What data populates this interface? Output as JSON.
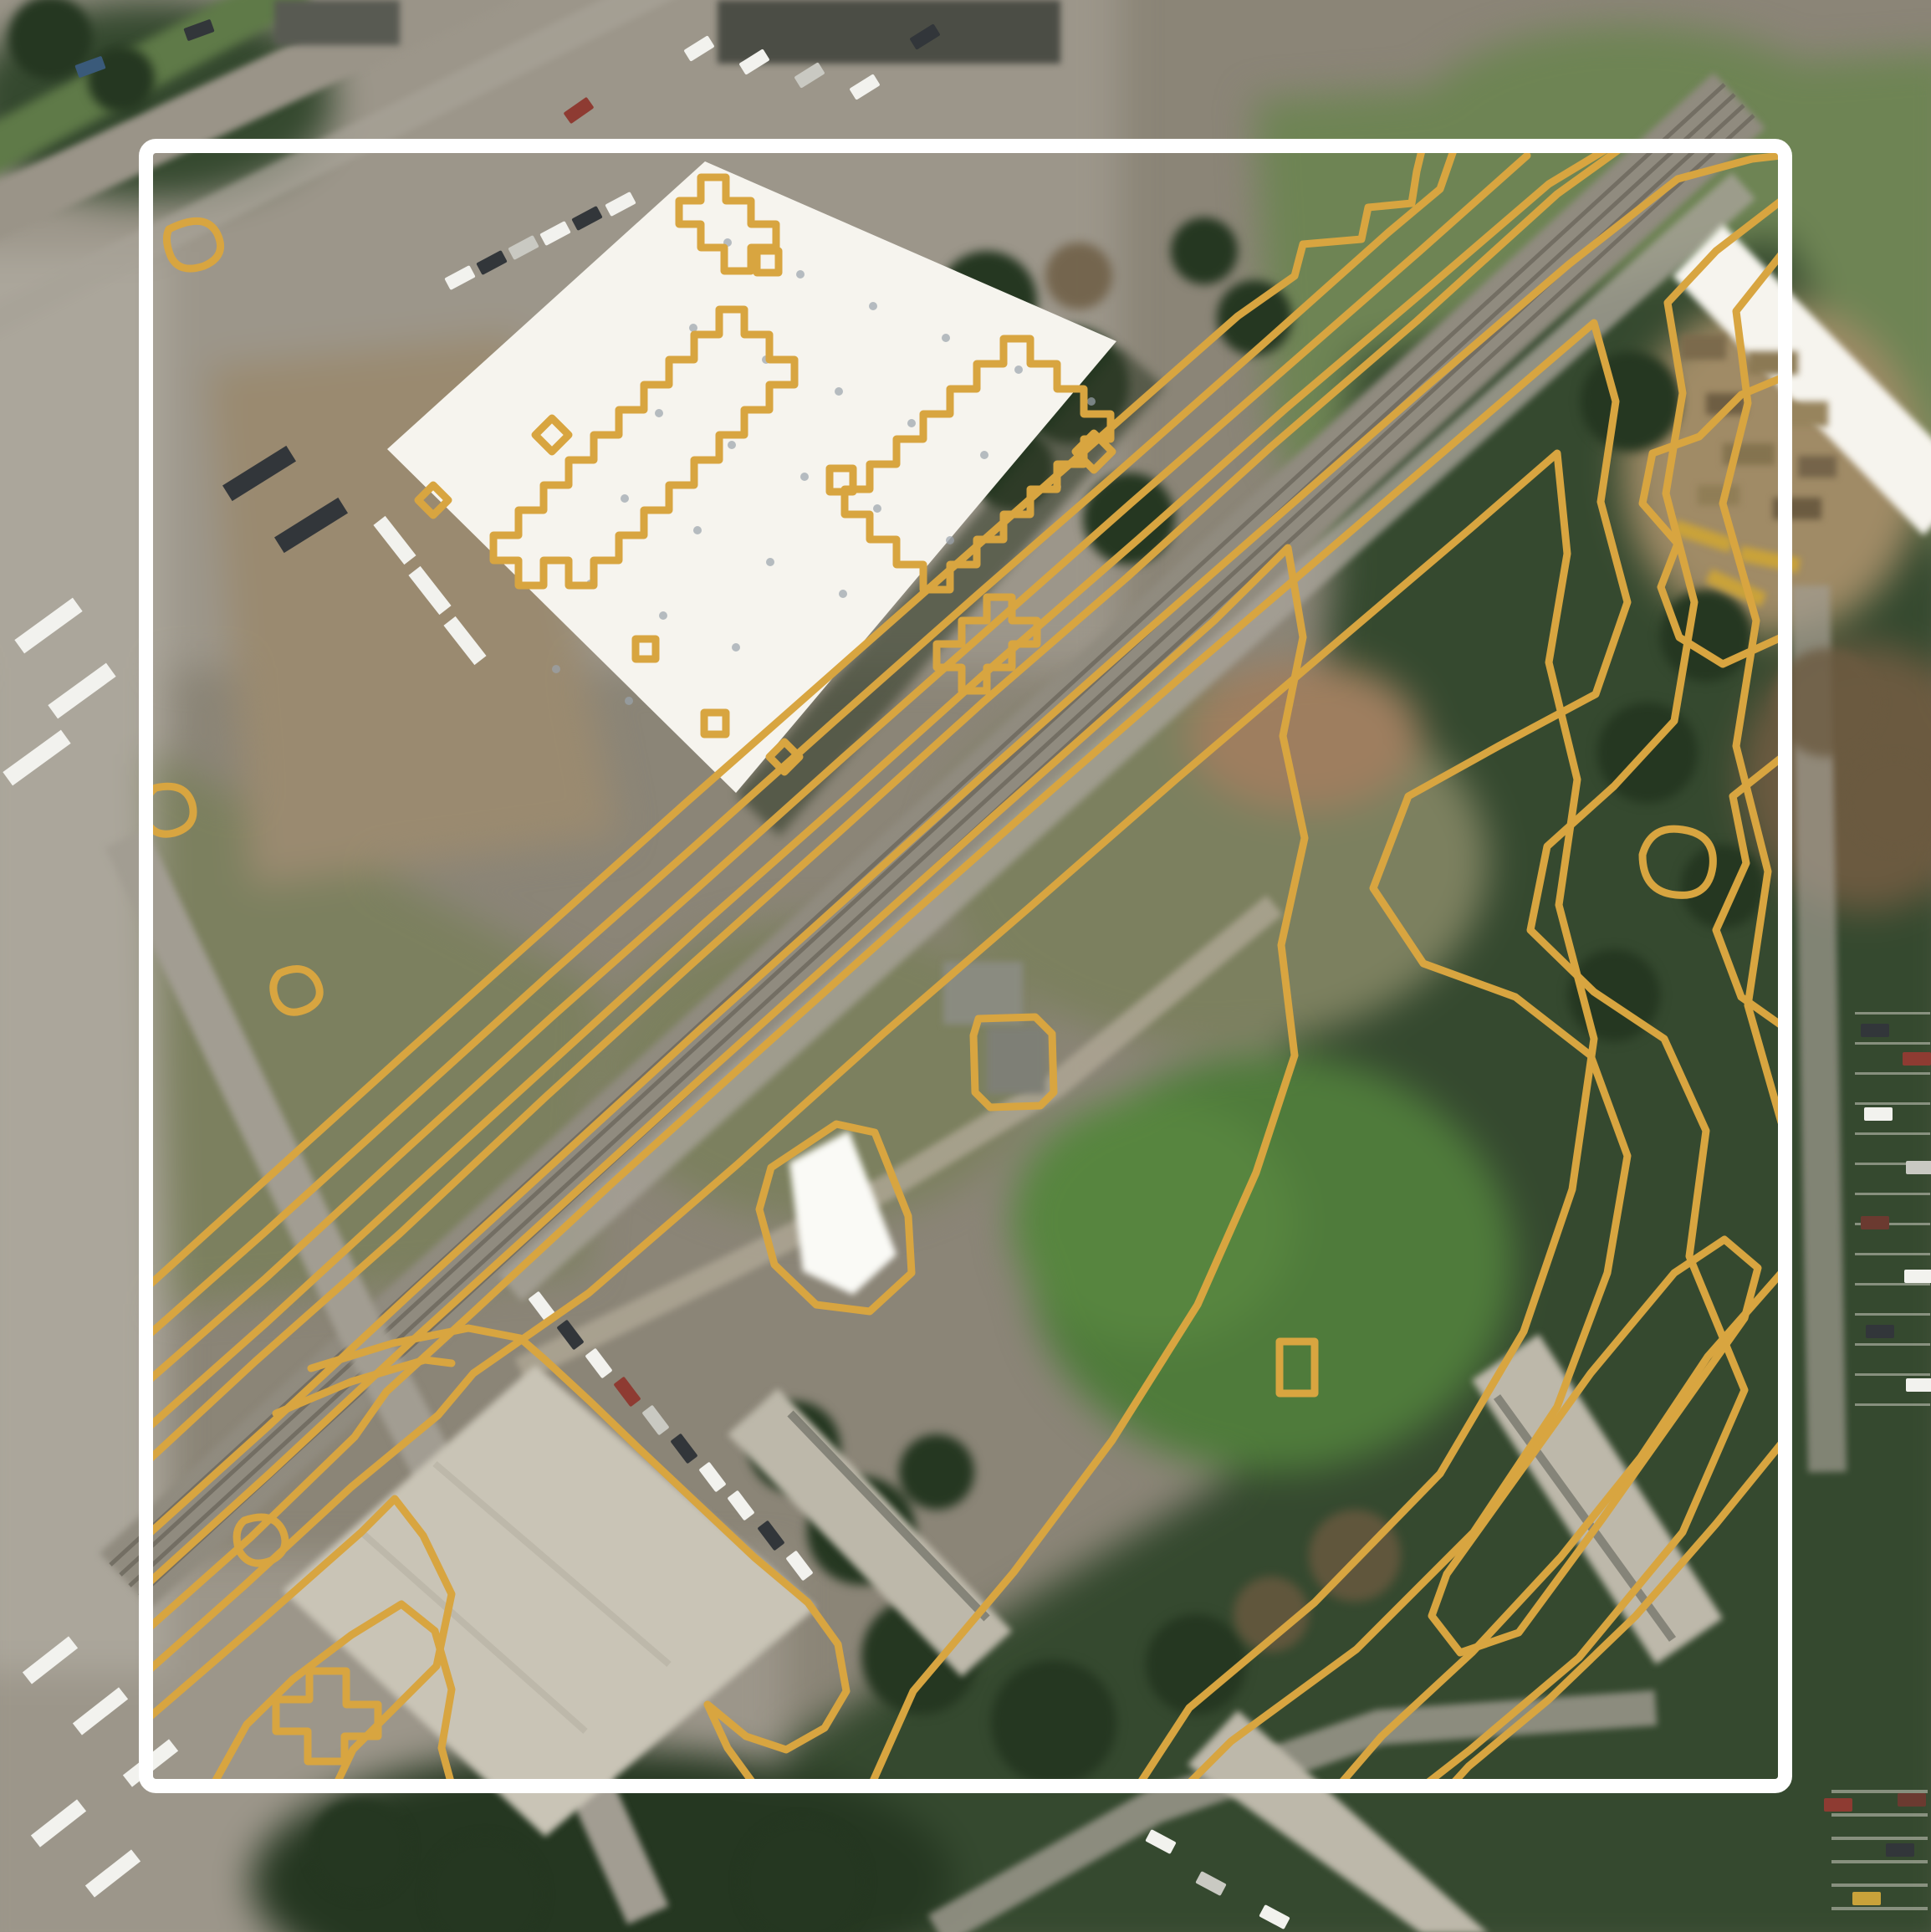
{
  "map": {
    "type": "satellite-with-contour-overlay",
    "contour_color": "#D8A540",
    "frame_color": "#FFFFFF",
    "palette": {
      "ground": "#8B8577",
      "pavement": "#9C968A",
      "pavement_light": "#ABA69B",
      "dirt": "#9A8A70",
      "dirt_red": "#9E7E5F",
      "scrub": "#7C805F",
      "grass": "#6E8454",
      "field": "#4F7B3B",
      "lawn": "#57853F",
      "woods": "#35492F",
      "woods_deep": "#253721",
      "rail_bed": "#908B7F",
      "rail_dark": "#6C685D",
      "road": "#A29D92",
      "driveway": "#B0A896",
      "roof_white": "#F6F4EE",
      "roof_gray": "#C9C4B6",
      "roof_dark": "#4B4D45",
      "apartment_roof": "#BDB8AA",
      "shed_white": "#FAFAF6",
      "shadow": "#343E2B",
      "roof_vent": "#9AA3AC",
      "car_white": "#F2F2EE",
      "car_silver": "#C9C9C2",
      "car_dark": "#32363A",
      "car_red": "#8E3B32",
      "car_maroon": "#6B3A30",
      "car_blue": "#3A5A7A",
      "bus_yellow": "#C9A23A",
      "junk_tan": "#A08B66",
      "stall_stripe": "#D9D7CD"
    },
    "features": [
      "aerial-imagery",
      "elevation-contour-overlay",
      "map-extent-frame",
      "railroad-corridor",
      "warehouse-white-roof",
      "industrial-building",
      "apartment-buildings",
      "parking-lots",
      "wooded-hillside",
      "open-field"
    ]
  }
}
